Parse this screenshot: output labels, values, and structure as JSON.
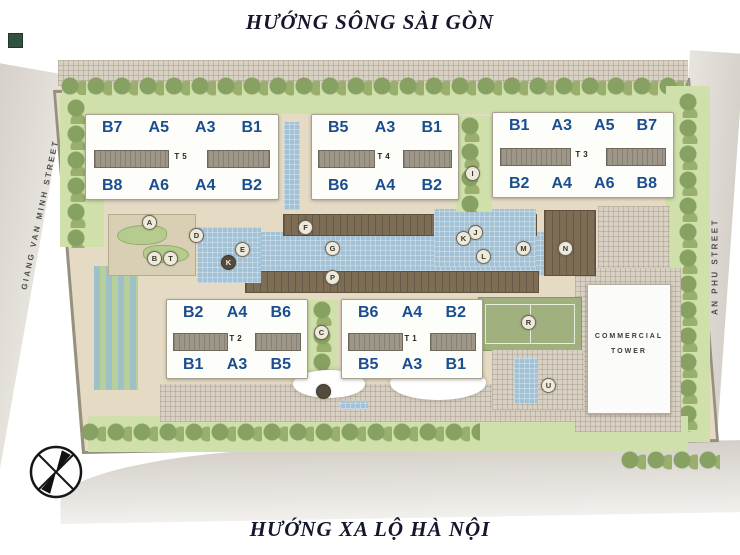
{
  "titles": {
    "top": "HƯỚNG SÔNG SÀI GÒN",
    "bottom": "HƯỚNG XA LỘ HÀ NỘI"
  },
  "streets": {
    "left": "GIANG VAN MINH STREET",
    "right": "AN PHU STREET"
  },
  "towers": [
    {
      "id": "T5",
      "label": "T5",
      "top_units": [
        "B7",
        "A5",
        "A3",
        "B1"
      ],
      "bottom_units": [
        "B8",
        "A6",
        "A4",
        "B2"
      ]
    },
    {
      "id": "T4",
      "label": "T4",
      "top_units": [
        "B5",
        "A3",
        "B1"
      ],
      "bottom_units": [
        "B6",
        "A4",
        "B2"
      ]
    },
    {
      "id": "T3",
      "label": "T3",
      "top_units": [
        "B1",
        "A3",
        "A5",
        "B7"
      ],
      "bottom_units": [
        "B2",
        "A4",
        "A6",
        "B8"
      ]
    },
    {
      "id": "T2",
      "label": "T2",
      "top_units": [
        "B2",
        "A4",
        "B6"
      ],
      "bottom_units": [
        "B1",
        "A3",
        "B5"
      ]
    },
    {
      "id": "T1",
      "label": "T1",
      "top_units": [
        "B6",
        "A4",
        "B2"
      ],
      "bottom_units": [
        "B5",
        "A3",
        "B1"
      ]
    }
  ],
  "commercial_tower": {
    "line1": "COMMERCIAL",
    "line2": "TOWER"
  },
  "amenity_markers": [
    {
      "letter": "A",
      "x": 149,
      "y": 222,
      "dark": false
    },
    {
      "letter": "B",
      "x": 154,
      "y": 258,
      "dark": false
    },
    {
      "letter": "T",
      "x": 170,
      "y": 258,
      "dark": false
    },
    {
      "letter": "D",
      "x": 196,
      "y": 235,
      "dark": false
    },
    {
      "letter": "E",
      "x": 242,
      "y": 249,
      "dark": false
    },
    {
      "letter": "K",
      "x": 228,
      "y": 262,
      "dark": true
    },
    {
      "letter": "F",
      "x": 305,
      "y": 227,
      "dark": false
    },
    {
      "letter": "G",
      "x": 332,
      "y": 248,
      "dark": false
    },
    {
      "letter": "P",
      "x": 332,
      "y": 277,
      "dark": false
    },
    {
      "letter": "C",
      "x": 321,
      "y": 332,
      "dark": false
    },
    {
      "letter": "I",
      "x": 472,
      "y": 173,
      "dark": false
    },
    {
      "letter": "J",
      "x": 475,
      "y": 232,
      "dark": false
    },
    {
      "letter": "K",
      "x": 463,
      "y": 238,
      "dark": false
    },
    {
      "letter": "L",
      "x": 483,
      "y": 256,
      "dark": false
    },
    {
      "letter": "M",
      "x": 523,
      "y": 248,
      "dark": false
    },
    {
      "letter": "N",
      "x": 565,
      "y": 248,
      "dark": false
    },
    {
      "letter": "R",
      "x": 528,
      "y": 322,
      "dark": false
    },
    {
      "letter": "U",
      "x": 548,
      "y": 385,
      "dark": false
    },
    {
      "letter": "",
      "x": 323,
      "y": 391,
      "dark": true
    }
  ],
  "colors": {
    "unit_label": "#1a4e8f",
    "title_text": "#16162c",
    "water": "#a4c2d6",
    "deck": "#7d6d55",
    "greenery": "#cfe0ab",
    "site_base": "#e5dbc4",
    "road": "#dad5cf"
  }
}
